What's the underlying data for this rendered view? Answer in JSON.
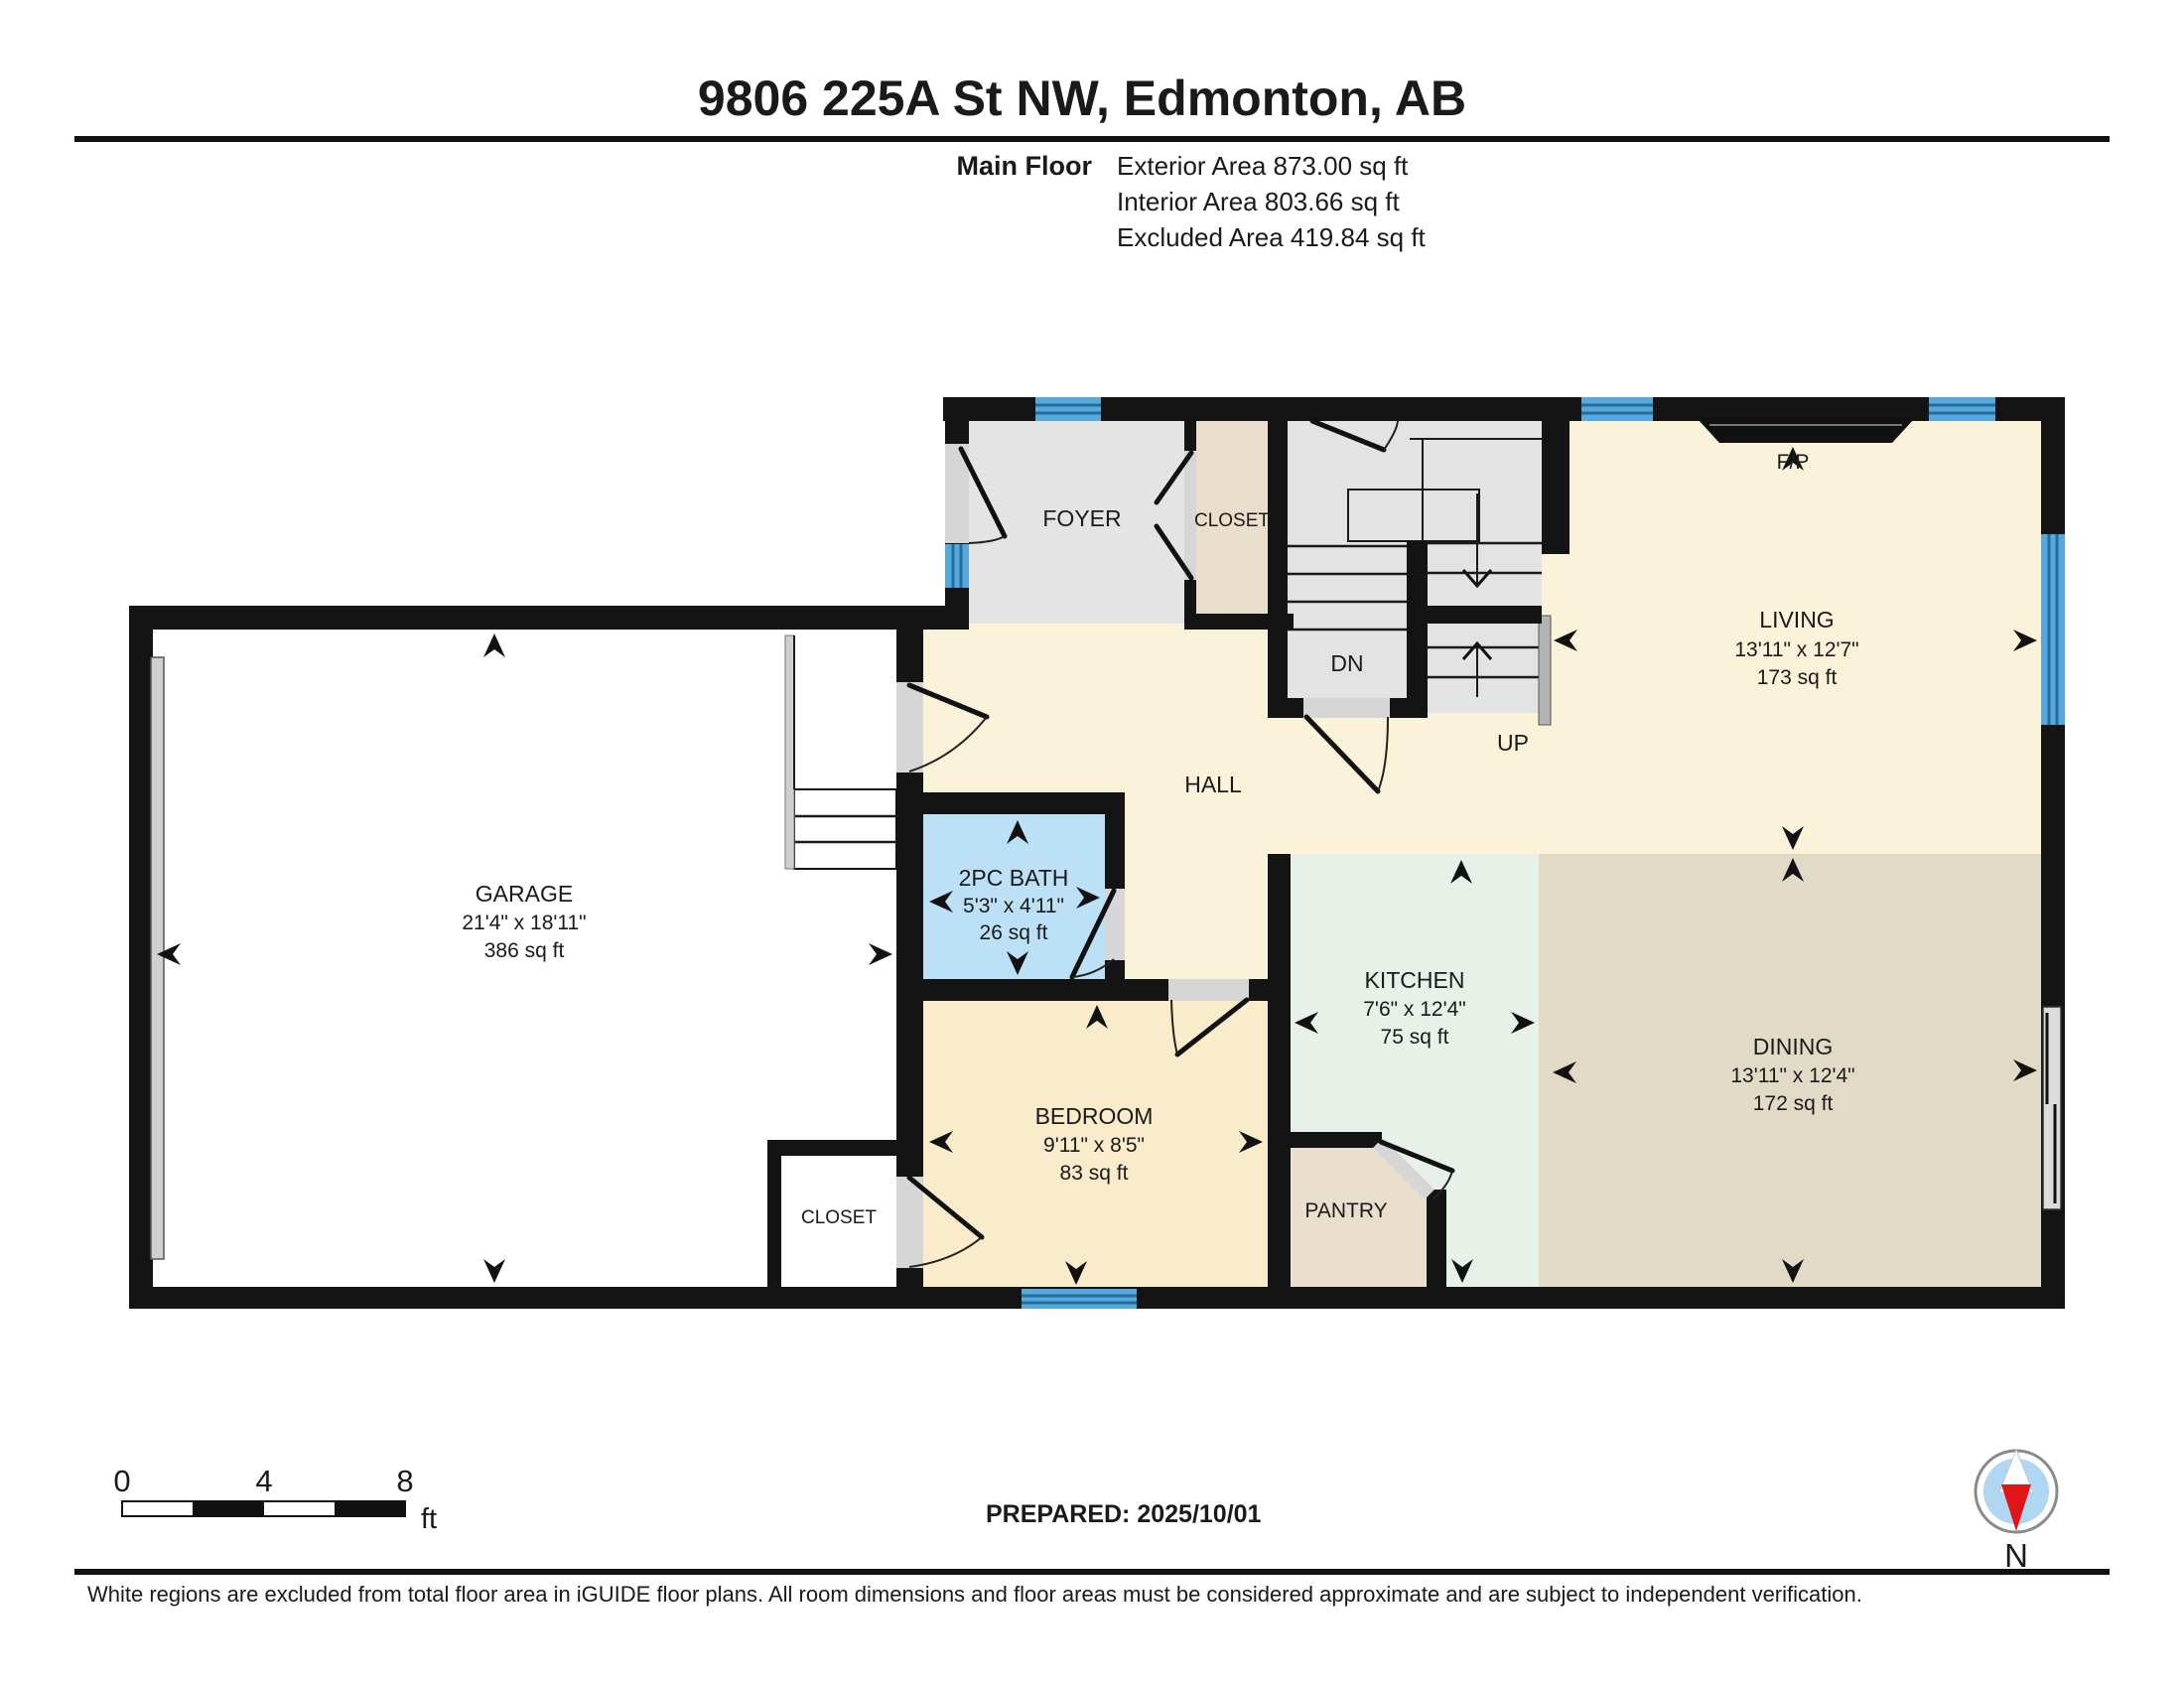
{
  "header": {
    "title": "9806 225A St NW, Edmonton, AB",
    "floor_label": "Main Floor",
    "area_lines": [
      "Exterior Area 873.00 sq ft",
      "Interior Area 803.66 sq ft",
      "Excluded Area 419.84 sq ft"
    ]
  },
  "rooms": {
    "garage": {
      "name": "GARAGE",
      "dims": "21'4\" x 18'11\"",
      "area": "386 sq ft"
    },
    "living": {
      "name": "LIVING",
      "dims": "13'11\" x 12'7\"",
      "area": "173 sq ft"
    },
    "dining": {
      "name": "DINING",
      "dims": "13'11\" x 12'4\"",
      "area": "172 sq ft"
    },
    "kitchen": {
      "name": "KITCHEN",
      "dims": "7'6\" x 12'4\"",
      "area": "75 sq ft"
    },
    "bedroom": {
      "name": "BEDROOM",
      "dims": "9'11\" x 8'5\"",
      "area": "83 sq ft"
    },
    "bath": {
      "name": "2PC BATH",
      "dims": "5'3\" x 4'11\"",
      "area": "26 sq ft"
    },
    "foyer": {
      "name": "FOYER"
    },
    "foyer_closet": {
      "name": "CLOSET"
    },
    "bedroom_closet": {
      "name": "CLOSET"
    },
    "pantry": {
      "name": "PANTRY"
    },
    "hall": {
      "name": "HALL"
    }
  },
  "stairs": {
    "down_label": "DN",
    "up_label": "UP"
  },
  "fireplace_label": "F/P",
  "compass": {
    "north_label": "N"
  },
  "scale_bar": {
    "ticks": [
      "0",
      "4",
      "8"
    ],
    "unit": "ft"
  },
  "footer": {
    "prepared": "PREPARED: 2025/10/01",
    "disclaimer": "White regions are excluded from total floor area in iGUIDE floor plans. All room dimensions and floor areas must be considered approximate and are subject to independent verification."
  },
  "colors": {
    "wall": "#141414",
    "window_blue": "#57A9DC",
    "hall_living_cream": "#FBF2DA",
    "bedroom_peach": "#FAEBCB",
    "dining_tan": "#E1DAC7",
    "kitchen_mint": "#E7F1E8",
    "bath_blue": "#BCE0F6",
    "closet_beige": "#EADFCD",
    "stairs_gray": "#E3E3E3",
    "compass_red": "#E01515"
  }
}
